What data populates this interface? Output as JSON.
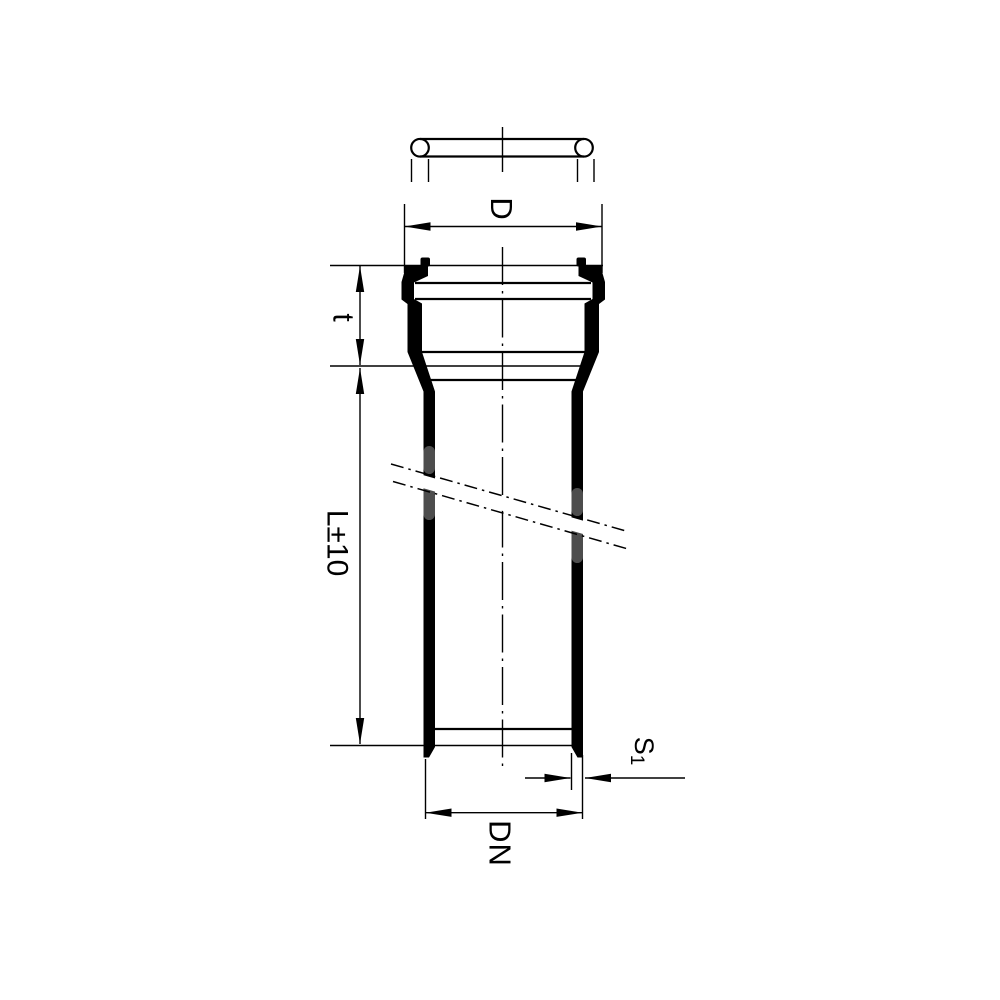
{
  "drawing": {
    "title": "pipe-with-socket-section-drawing",
    "labels": {
      "socket_outer_diameter": "D",
      "socket_depth": "t",
      "pipe_length": "L±10",
      "nominal_diameter": "DN",
      "wall_thickness_symbol": "S",
      "wall_thickness_subscript": "1"
    },
    "colors": {
      "line": "#000000",
      "background": "#ffffff",
      "break_cap_gray": "#4d4d4d"
    }
  }
}
